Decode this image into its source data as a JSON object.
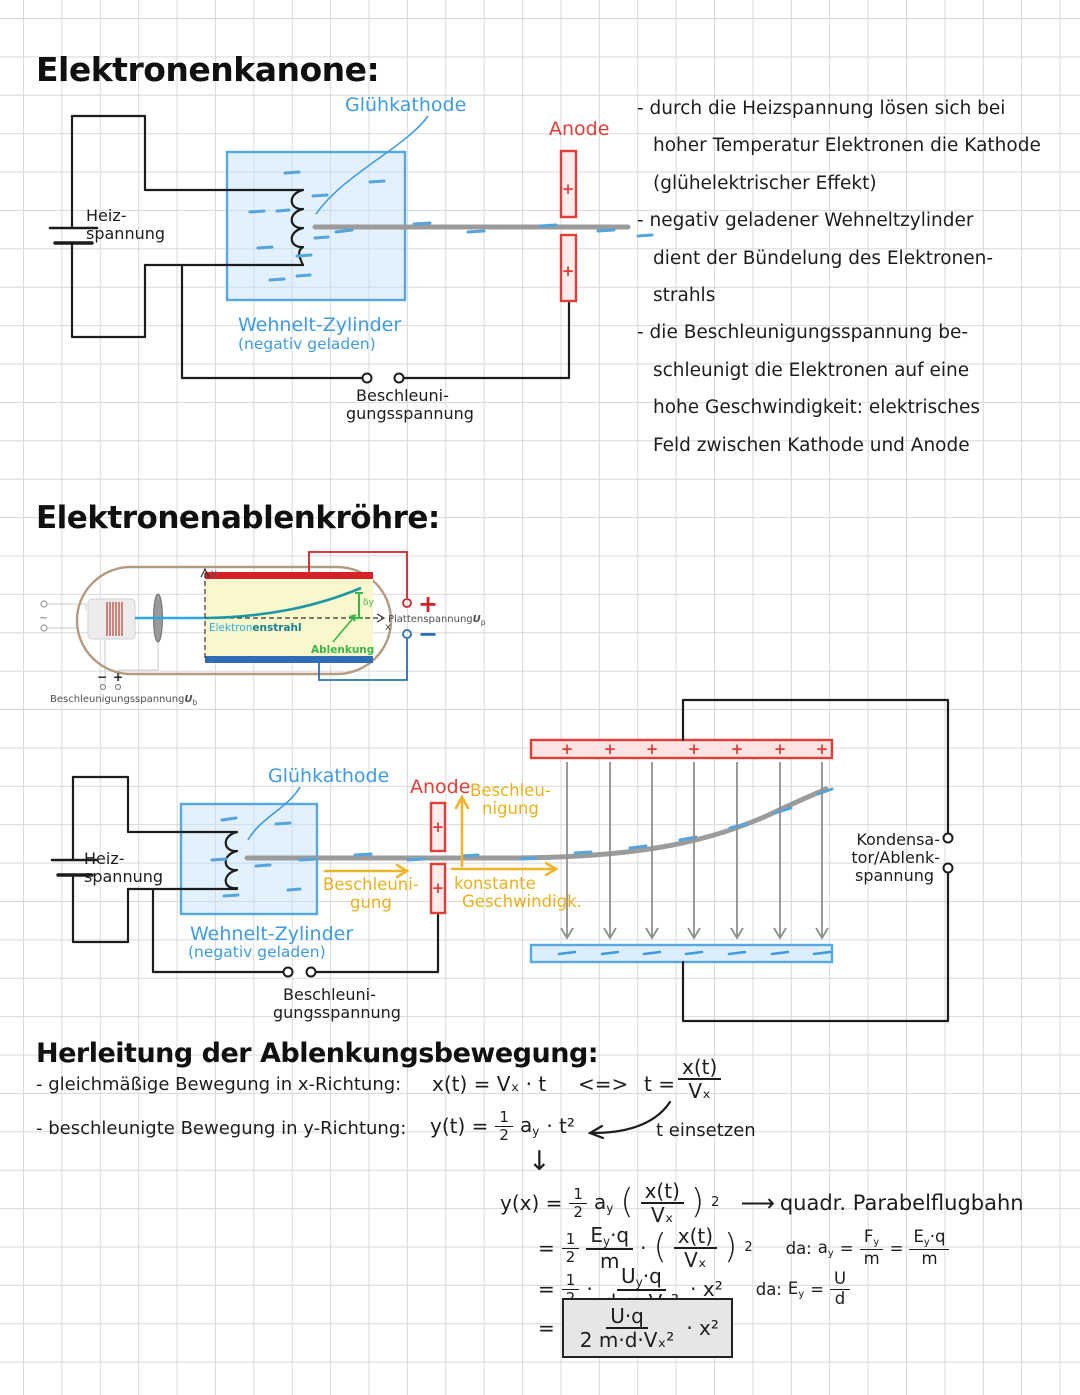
{
  "sym": {
    "plus": "+",
    "minus": "−",
    "tilde": "~",
    "iff": "<=>",
    "down_arrow": "↓",
    "long_arrow": "⟶",
    "open": "(",
    "close": ")",
    "sup2": "2",
    "eq": "=",
    "dot": "·"
  },
  "half": {
    "n": "1",
    "d": "2"
  },
  "kanone": {
    "title": "Elektronenkanone:",
    "labels": {
      "gluehkathode": "Glühkathode",
      "anode": "Anode",
      "heiz1": "Heiz-",
      "heiz2": "spannung",
      "wehnelt1": "Wehnelt-Zylinder",
      "wehnelt2": "(negativ geladen)",
      "beschl1": "Beschleuni-",
      "beschl2": "gungsspannung"
    },
    "bullets": [
      "- durch die Heizspannung lösen sich bei\nhoher Temperatur Elektronen die Kathode\n(glühelektrischer Effekt)",
      "- negativ geladener Wehneltzylinder\ndient der Bündelung des Elektronen-\nstrahls",
      "- die Beschleunigungsspannung be-\nschleunigt die Elektronen auf eine\nhohe Geschwindigkeit: elektrisches\nFeld zwischen Kathode und Anode"
    ]
  },
  "roehre": {
    "title": "Elektronenablenkröhre:",
    "fig": {
      "strahl1": "Elektron",
      "strahl2": "enstrahl",
      "ablenkung": "Ablenkung",
      "dy": "δy",
      "x_axis": "x",
      "y_axis": "y",
      "plattenspannung": "Plattenspannung",
      "u_p_base": "U",
      "u_p_sub": "p",
      "beschleunigungsspannung": "Beschleunigungsspannung",
      "u_b_base": "U",
      "u_b_sub": "b"
    },
    "diagram2": {
      "gluehkathode": "Glühkathode",
      "anode": "Anode",
      "heiz1": "Heiz-",
      "heiz2": "spannung",
      "wehnelt1": "Wehnelt-Zylinder",
      "wehnelt2": "(negativ geladen)",
      "beschl1": "Beschleuni-",
      "beschl2": "gungsspannung",
      "beschleunigung_up1": "Beschleu-",
      "beschleunigung_up2": "nigung",
      "beschleunigung_r1": "Beschleuni-",
      "beschleunigung_r2": "gung",
      "konstant1": "konstante",
      "konstant2": "Geschwindigk.",
      "kondensator1": "Kondensa-",
      "kondensator2": "tor/Ablenk-",
      "kondensator3": "spannung"
    }
  },
  "herleitung": {
    "title": "Herleitung der Ablenkungsbewegung:",
    "row1": {
      "label": "- gleichmäßige Bewegung in x-Richtung:",
      "eq": "x(t) = Vₓ · t",
      "t_lhs": "t =",
      "num": "x(t)",
      "den": "Vₓ"
    },
    "row2": {
      "label": "- beschleunigte Bewegung in y-Richtung:",
      "lhs": "y(t) =",
      "a": "a",
      "a_sub": "y",
      "tail": "· t²",
      "note": "t einsetzen"
    },
    "d1": {
      "lhs": "y(x) =",
      "a": "a",
      "a_sub": "y",
      "num": "x(t)",
      "den": "Vₓ",
      "result": "quadr. Parabelflugbahn"
    },
    "d2": {
      "E": "E",
      "E_sub": "y",
      "E_tail": "·q",
      "den": "m",
      "pnum": "x(t)",
      "pden": "Vₓ",
      "da": "da:",
      "na": "a",
      "na_sub": "y",
      "nF": "F",
      "nF_sub": "y",
      "nF_den": "m",
      "nE": "E",
      "nE_sub": "y",
      "nE_tail": "·q",
      "nE_den": "m"
    },
    "d3": {
      "U": "U",
      "U_sub": "y",
      "U_tail": "·q",
      "den": "d·m·Vₓ²",
      "tail": "· x²",
      "da": "da:",
      "nE": "E",
      "nE_sub": "y",
      "n_num": "U",
      "n_den": "d"
    },
    "d4": {
      "num": "U·q",
      "den": "2 m·d·Vₓ²",
      "tail": "· x²"
    }
  }
}
